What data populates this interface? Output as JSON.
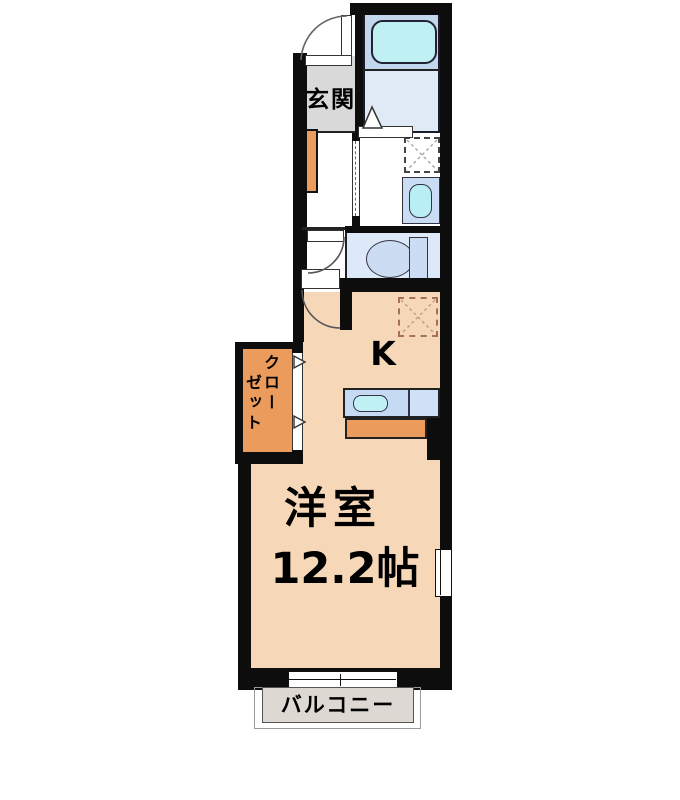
{
  "plan": {
    "labels": {
      "entrance": "玄関",
      "kitchen": "K",
      "closet_column1": "クロー",
      "closet_column2": "ゼット",
      "room_name": "洋室",
      "room_size": "12.2帖",
      "balcony": "バルコニー"
    },
    "colors": {
      "wall": "#0d0d0d",
      "room_floor": "#f6d8b8",
      "accent_orange": "#eb9b5c",
      "bath_zone": "#c2d6ec",
      "bath_floor": "#dfeaf6",
      "toilet_floor": "#dde9f8",
      "fixture_blue": "#ccddf3",
      "water_cyan": "#bfeef4",
      "entrance_floor": "#d9d9d9",
      "balcony_floor": "#ded8d2",
      "refrigerator_dash": "#a5705a"
    },
    "fixtures": [
      "bathtub",
      "washing-machine-space",
      "wash-basin",
      "toilet",
      "refrigerator-space",
      "kitchen-sink",
      "kitchen-counter",
      "closet",
      "shoe-cabinet",
      "balcony"
    ]
  }
}
